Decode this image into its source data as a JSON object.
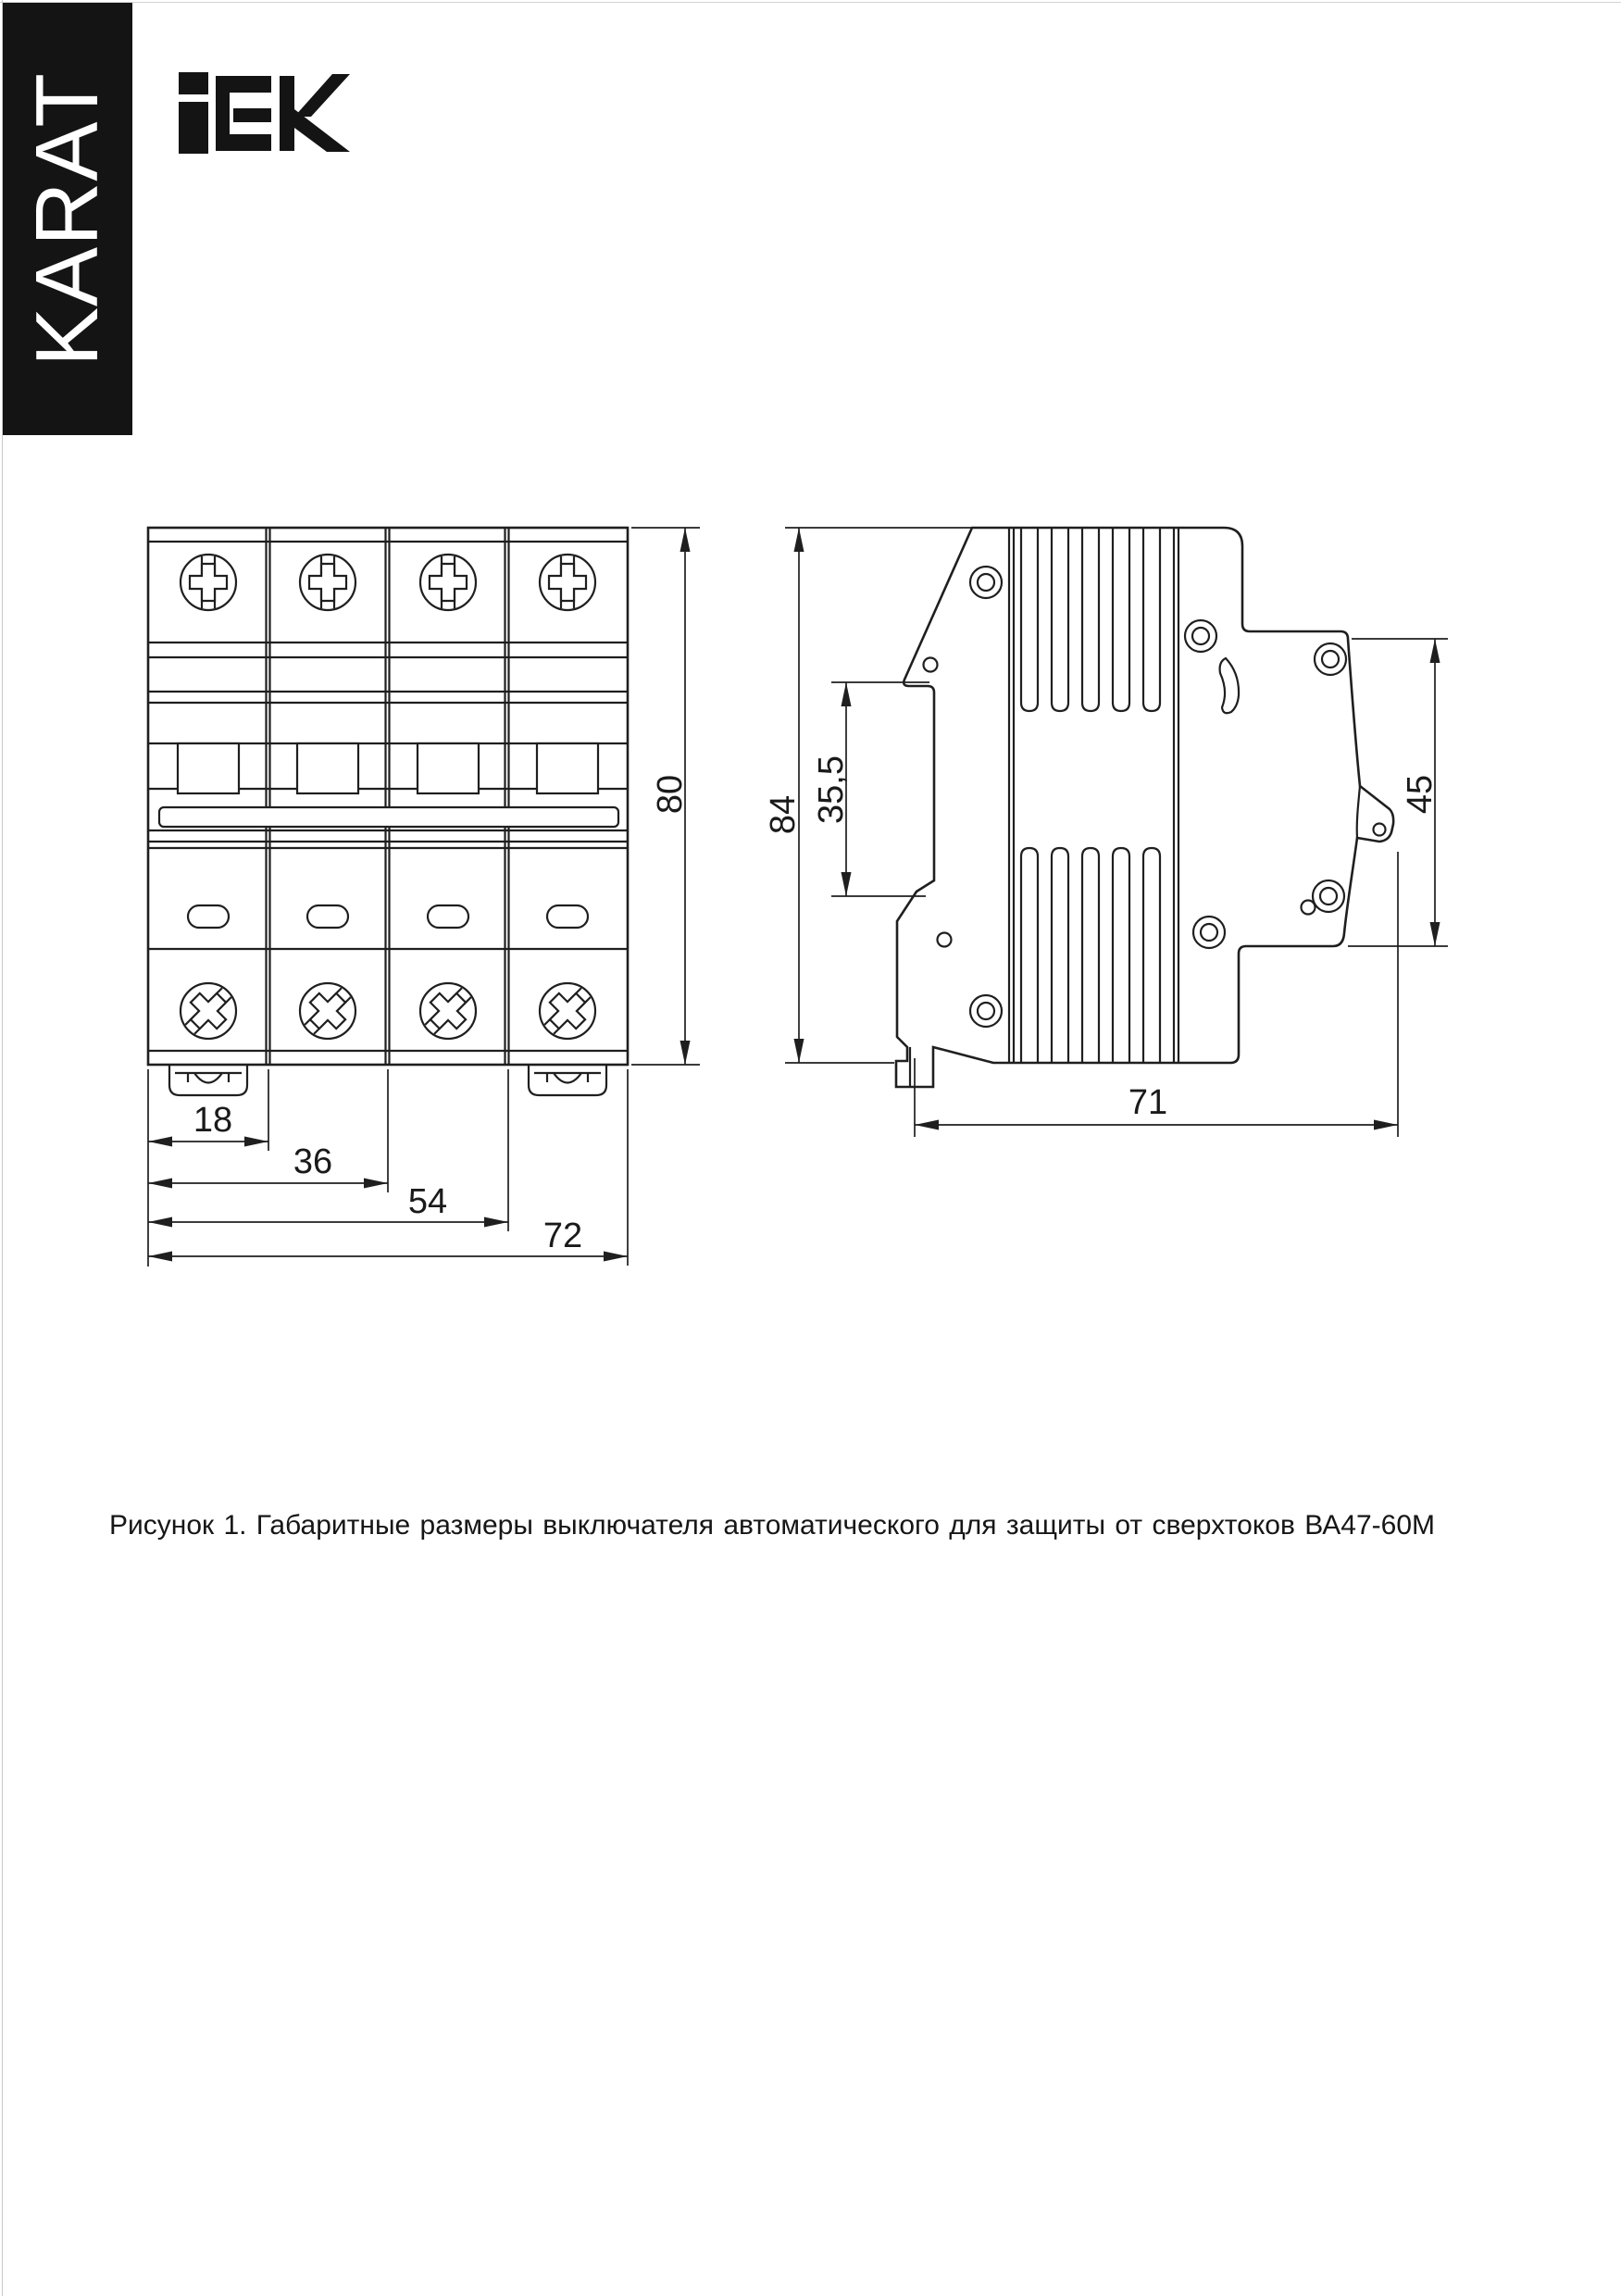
{
  "brand": {
    "series_label": "KARAT",
    "logo_text": "IEK"
  },
  "figure": {
    "caption": "Рисунок 1. Габаритные размеры выключателя автоматического для защиты от сверхтоков ВА47-60М",
    "dimensions": {
      "front_width_1": "18",
      "front_width_2": "36",
      "front_width_3": "54",
      "front_width_total": "72",
      "front_height": "80",
      "side_height_total": "84",
      "side_din_top_offset": "35,5",
      "side_back_height": "45",
      "side_depth": "71"
    }
  }
}
